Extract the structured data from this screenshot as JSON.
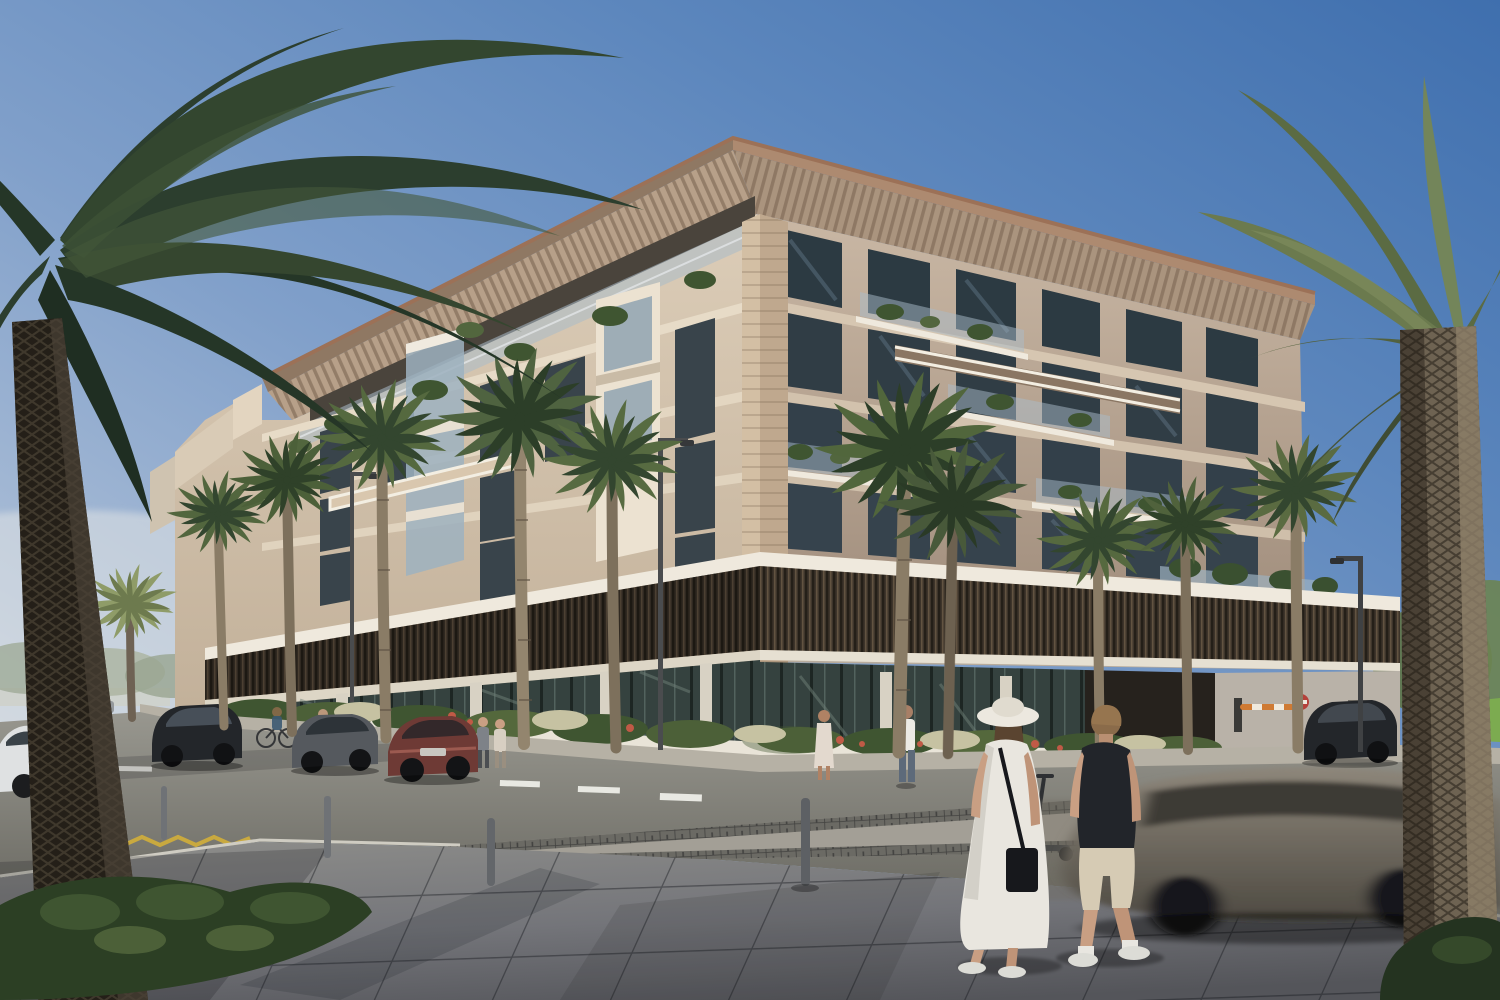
{
  "scene": {
    "type": "architectural-exterior-rendering",
    "time_of_day": "clear sunny day",
    "description": "Corner street view of a modern six-storey cream residential building with a slatted roof canopy, glass balconies with planting, a dark bronze louvered podium band, glass storefronts, palm-lined sidewalks, parked cars, a blurred passing SUV and a couple crossing the paved plaza in the foreground",
    "visible_text": []
  },
  "palette": {
    "sky_top": "#3f6fae",
    "sky_upper": "#5d87bd",
    "sky_mid": "#81a0ca",
    "sky_low": "#aabdd6",
    "sky_horizon": "#d6dce3",
    "facade_sun_top": "#dccdb8",
    "facade_sun_bot": "#c0ae97",
    "facade_shade_top": "#c9b7a4",
    "facade_shade_bot": "#a3907f",
    "band_cream": "#e7dbc7",
    "roof_slat": "#c2ac94",
    "roof_slat_dark": "#a08a74",
    "roof_edge": "#9c7157",
    "stone": "#cdb89c",
    "stone_shade": "#b49e84",
    "window_dark": "#2c3a42",
    "window_reflect": "#5d7282",
    "glass_rail": "#a9bcc9",
    "louver": "#3e352b",
    "louver_dark": "#241f18",
    "louver_hi": "#6a5a46",
    "white_trim": "#efe9dd",
    "ground_glass": "#35423f",
    "sidewalk": "#b6b1a5",
    "asphalt_light": "#98978f",
    "asphalt_dark": "#686760",
    "plaza": "#74757a",
    "plaza_shade": "#54555a",
    "crossing": "#a39f96",
    "lane_white": "#e8e8e2",
    "lane_yellow": "#c9a93f",
    "palm_deep": "#27382a",
    "palm_dark": "#33462f",
    "palm_mid": "#52663e",
    "palm_light": "#73855a",
    "palm_pale": "#8f9c68",
    "trunk_dark": "#241f18",
    "trunk_mid": "#5d5243",
    "trunk_light": "#8a7c66",
    "bush_dark": "#2c3f24",
    "bush_mid": "#3f5531",
    "lawn": "#7cab50",
    "grass_pale": "#c6c2a2",
    "flower_red": "#c05a46",
    "car_black": "#23262a",
    "car_gray": "#55595e",
    "car_silver": "#b9bcbf",
    "car_white": "#dfe1e2",
    "car_maroon": "#6e3a35",
    "car_blur": "#7d766a",
    "tire": "#1c1d1f",
    "skin": "#c99f83",
    "hair_brown": "#5a4430",
    "hair_light": "#8a6b4a",
    "hat_white": "#ece8df",
    "dress_white": "#e9e6df",
    "polo_black": "#22252a",
    "shorts_beige": "#d6cbb4",
    "shoe_white": "#dcdcd6",
    "bag_black": "#17181c",
    "lamp_pole": "#4a4c4e",
    "bollard": "#6f7276",
    "barrier_orange": "#cf7a33",
    "sign_red": "#b5413a"
  },
  "objects": [
    {
      "name": "residential-building",
      "floors_visible": 6,
      "features": "slatted roof canopy with bronze fascia, travertine corner column, balconies with glass balustrades and plants, bronze vertical-louver podium band, glass ground-floor storefronts"
    },
    {
      "name": "foreground-palm-left",
      "kind": "large date palm, dark green fronds, thick dark diamond-textured trunk"
    },
    {
      "name": "foreground-palm-right",
      "kind": "tall palm, olive fronds, light diamond-textured trunk"
    },
    {
      "name": "street-palms",
      "count": 10,
      "kind": "slender royal palms along both facades"
    },
    {
      "name": "parked-vehicles-left",
      "items": [
        "white car sliver",
        "black SUV",
        "gray sedan",
        "maroon sedan"
      ]
    },
    {
      "name": "parked-suv-right",
      "color": "dark gray"
    },
    {
      "name": "moving-car",
      "state": "motion-blurred, driving through foreground right"
    },
    {
      "name": "pedestrian-couple",
      "woman": "white maxi dress, white sun hat, black crossbody bag, white sneakers",
      "man": "black polo, beige shorts, white socks and sneakers"
    },
    {
      "name": "background-pedestrians",
      "count": 5
    },
    {
      "name": "cyclists",
      "count": 2
    },
    {
      "name": "e-scooter",
      "state": "parked near crossing"
    },
    {
      "name": "street-lamps",
      "count": 3
    },
    {
      "name": "bollards",
      "count": 4
    },
    {
      "name": "parking-barrier",
      "color": "orange arm"
    },
    {
      "name": "no-entry-sign",
      "shape": "small red disc on post"
    },
    {
      "name": "road-markings",
      "items": [
        "white lane dashes",
        "yellow zigzag marks",
        "raised paved crossing"
      ]
    },
    {
      "name": "landscaping",
      "items": [
        "white planter walls",
        "green shrubs",
        "pale ornamental grasses",
        "red flower accents",
        "lawn strip right"
      ]
    }
  ]
}
